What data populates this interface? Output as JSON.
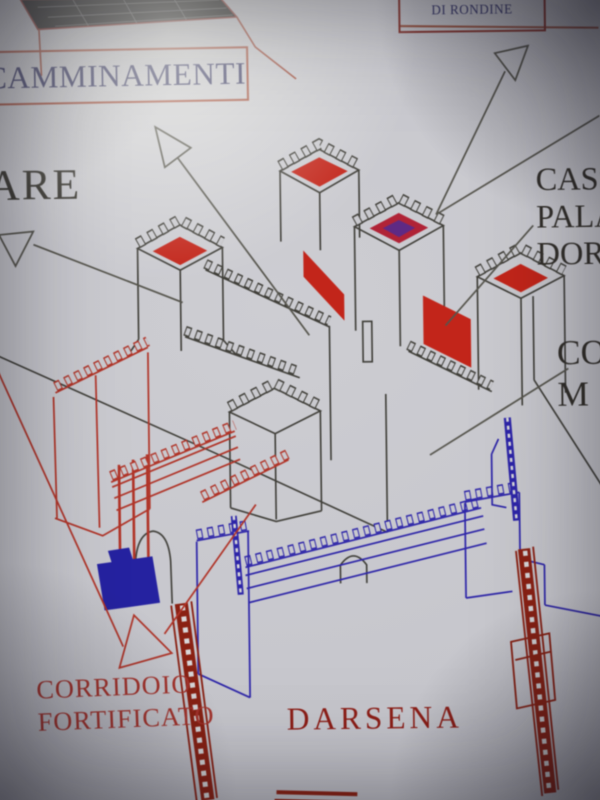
{
  "labels": {
    "merlon_box": {
      "line1": "MERLO A CODA",
      "line2": "DI RONDINE"
    },
    "walkways_box": "CAMMINAMENTI",
    "left_partial": "ARE",
    "right_partial": {
      "line1": "CASS",
      "line2": "PALA",
      "line3": "DOR"
    },
    "right_mid_partial": {
      "line1": "CO",
      "line2": "M"
    },
    "fortified_corridor": {
      "line1": "CORRIDOIO",
      "line2": "FORTIFICATO"
    },
    "dock": "DARSENA"
  },
  "colors": {
    "paper": "#c9c9ce",
    "castle_outline": "#3f3e38",
    "roof_red": "#c2251a",
    "roof_purple": "#5e2a84",
    "corridor_red": "#b03428",
    "darsena_blue": "#2d25a8",
    "water_blue": "#2522a0",
    "post_red": "#8a2113",
    "label_navy": "#32325f",
    "label_dark": "#35332d",
    "label_red": "#a5332c",
    "label_dark_red": "#8c1d16",
    "box_border": "#9c4838"
  }
}
